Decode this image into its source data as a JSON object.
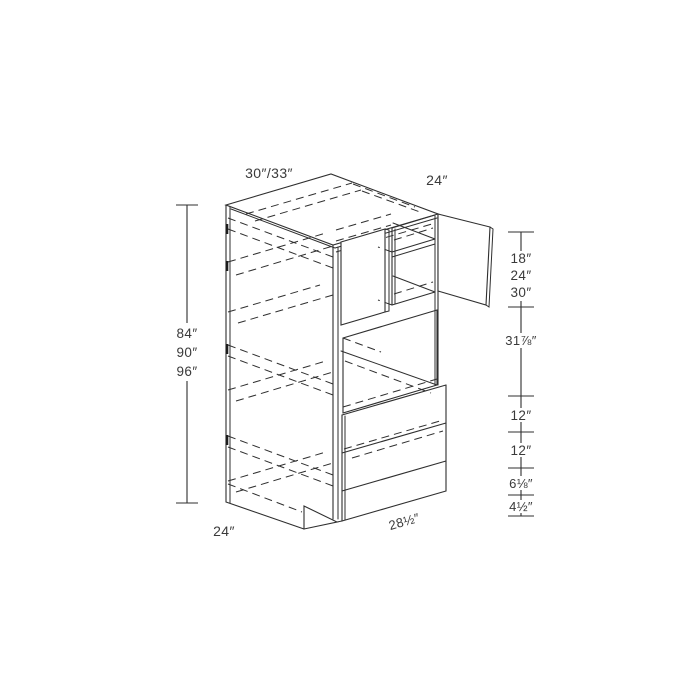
{
  "diagram": {
    "description": "Isometric line drawing of a tall double-oven kitchen cabinet with upper door compartment, oven cavity opening and three-drawer base, annotated with dimension lines",
    "colors": {
      "line": "#2f2f2f",
      "text": "#3a3a3a",
      "background": "#ffffff"
    },
    "labels": {
      "top_width": "30″/33″",
      "top_depth": "24″",
      "height_options": [
        "84″",
        "90″",
        "96″"
      ],
      "right_segments": {
        "upper_opening_options": [
          "18″",
          "24″",
          "30″"
        ],
        "oven_opening": "31⅞″",
        "upper_drawer": "12″",
        "middle_drawer": "12″",
        "lower_drawer": "6⅛″",
        "toe_kick": "4½″"
      },
      "bottom_depth": "24″",
      "bottom_width": "28½″"
    }
  }
}
